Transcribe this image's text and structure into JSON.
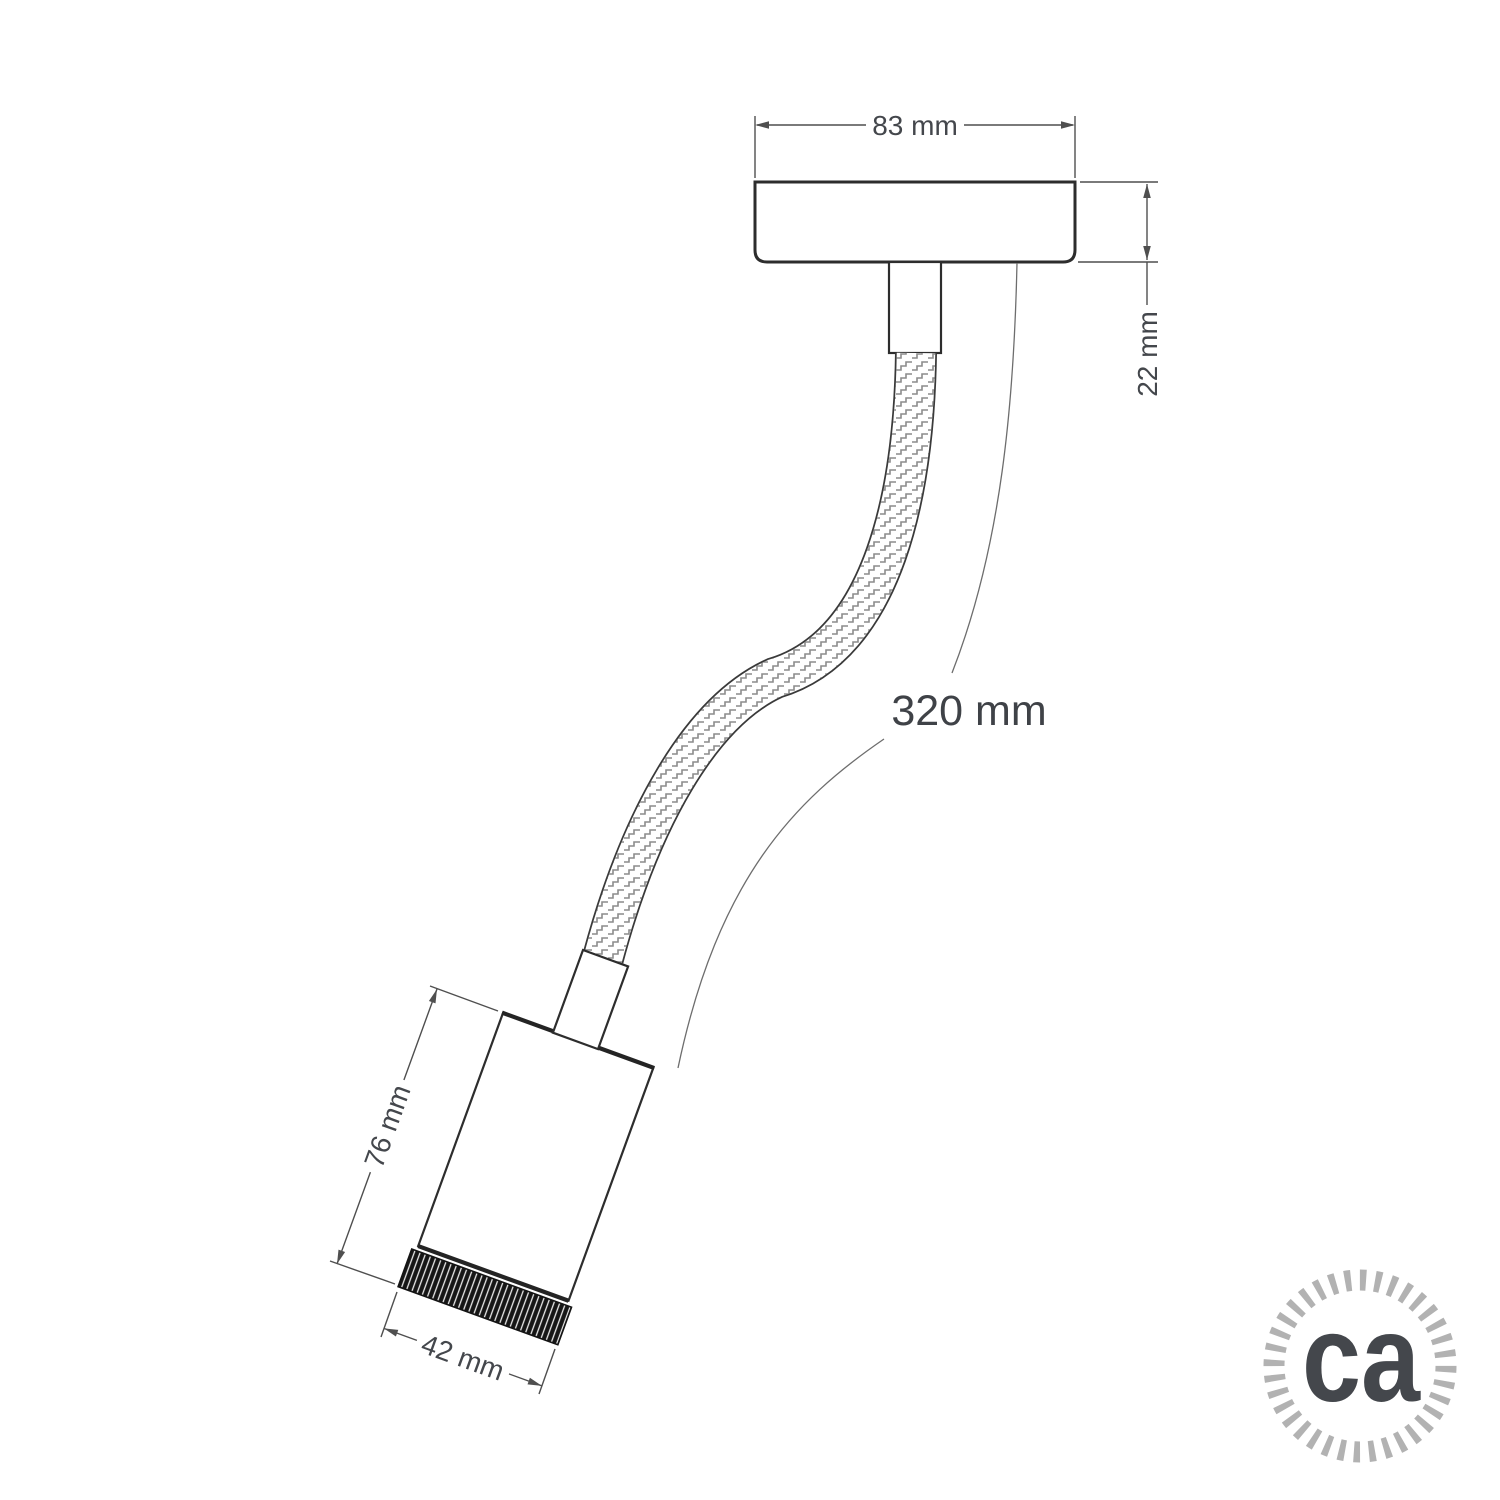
{
  "drawing": {
    "dimensions": {
      "canopy_width": "83 mm",
      "canopy_depth": "22 mm",
      "flex_length": "320 mm",
      "body_length": "76 mm",
      "body_diameter": "42 mm"
    }
  },
  "logo": {
    "text": "ca"
  },
  "colors": {
    "background": "#ffffff",
    "object_outline": "#2d2d2d",
    "dimension_line": "#4f4f4f",
    "label_text": "#44474c",
    "braid_texture": "#8c8c8c",
    "knurl_dark": "#161616",
    "logo_gray": "#b2b2b2"
  }
}
